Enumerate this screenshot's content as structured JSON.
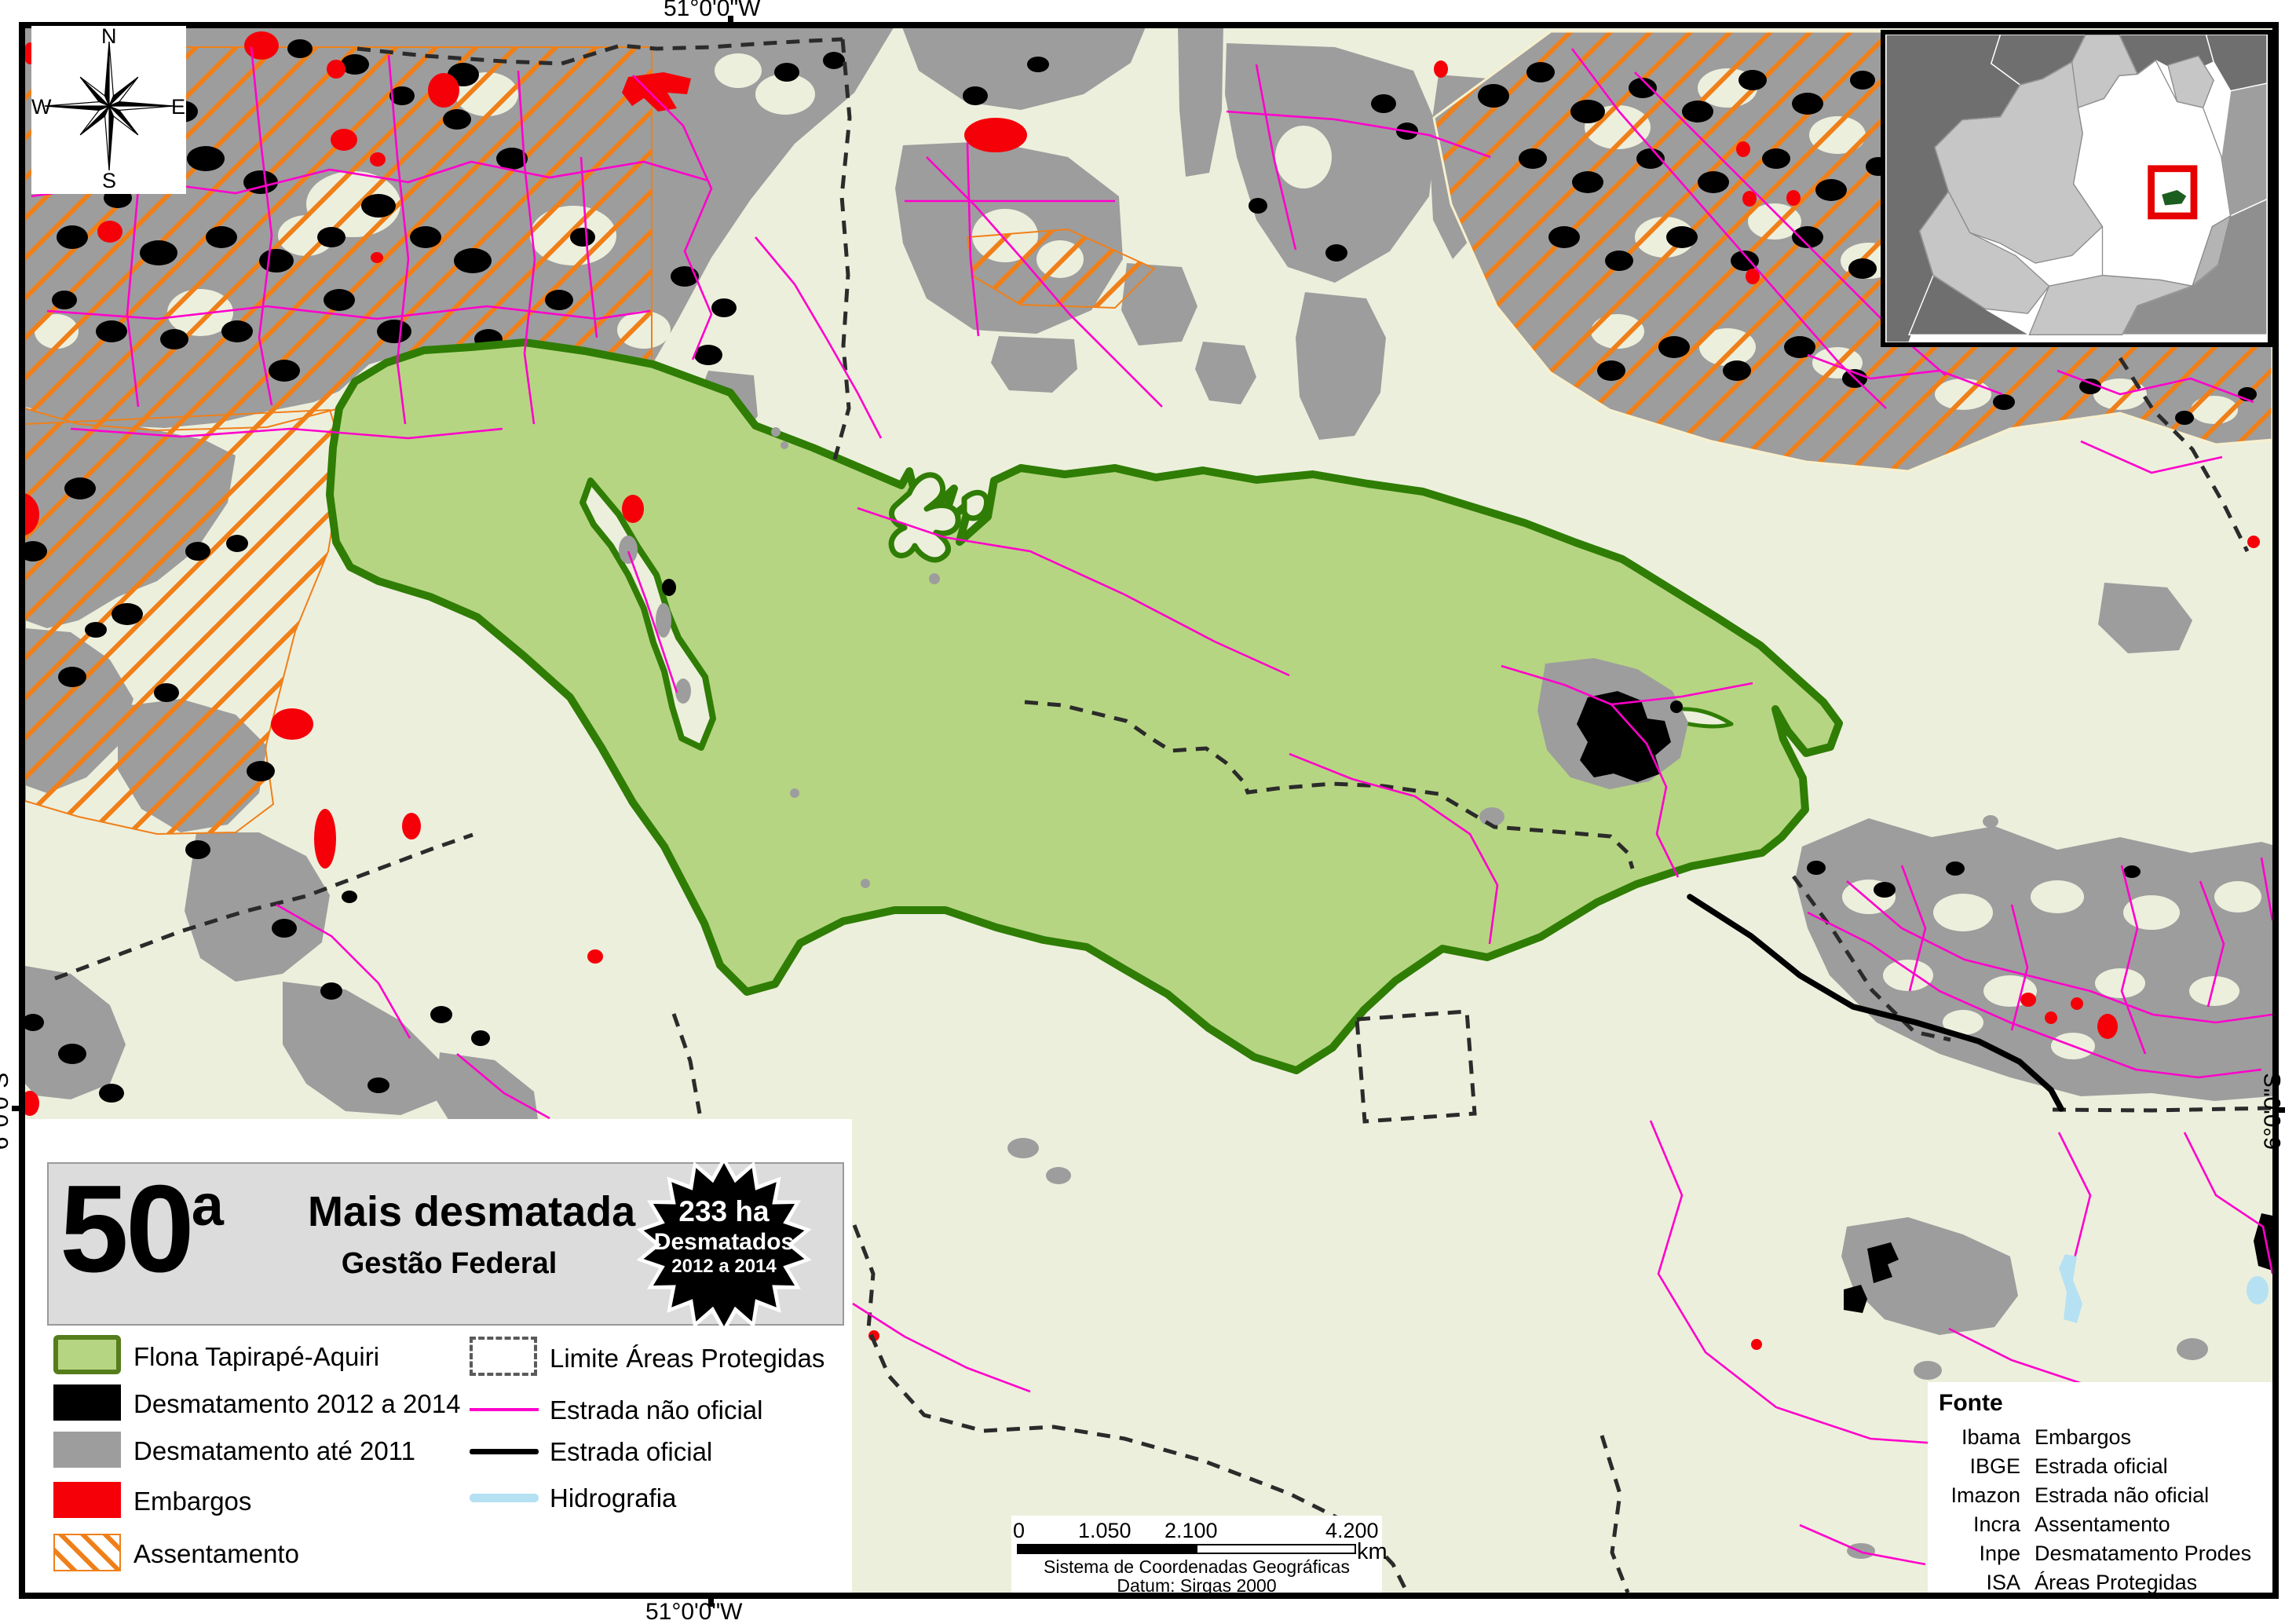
{
  "frame": {
    "coordinates": {
      "top": "51°0'0\"W",
      "bottom": "51°0'0\"W",
      "left": "6°0'0\"S",
      "right": "6°0'0\"S"
    }
  },
  "compass": {
    "n": "N",
    "e": "E",
    "s": "S",
    "w": "W"
  },
  "title_box": {
    "rank_number": "50",
    "rank_suffix": "a",
    "title": "Mais desmatada",
    "subtitle": "Gestão Federal"
  },
  "badge": {
    "line1": "233 ha",
    "line2": "Desmatados",
    "line3": "2012 a 2014"
  },
  "legend": {
    "col1": [
      {
        "label": "Flona Tapirapé-Aquiri",
        "color": "#b6d582",
        "border": "#567d1c"
      },
      {
        "label": "Desmatamento 2012 a 2014",
        "color": "#000000"
      },
      {
        "label": "Desmatamento até 2011",
        "color": "#9d9d9d"
      },
      {
        "label": "Embargos",
        "color": "#f50008"
      },
      {
        "label": "Assentamento",
        "color": "#ef8019",
        "style": "diagonal-hatch"
      }
    ],
    "col2": [
      {
        "label": "Limite Áreas Protegidas",
        "style": "dashed-outline",
        "color": "#5a5a5a"
      },
      {
        "label": "Estrada não oficial",
        "color": "#ff00cc"
      },
      {
        "label": "Estrada oficial",
        "color": "#000000"
      },
      {
        "label": "Hidrografia",
        "color": "#b5e1f3"
      }
    ]
  },
  "scale_bar": {
    "ticks": [
      "0",
      "1.050",
      "2.100",
      "4.200"
    ],
    "unit": "km",
    "crs_line1": "Sistema de Coordenadas Geográficas",
    "crs_line2": "Datum: Sirgas 2000"
  },
  "source_box": {
    "title": "Fonte",
    "entries": [
      {
        "source": "Ibama",
        "dataset": "Embargos"
      },
      {
        "source": "IBGE",
        "dataset": "Estrada oficial"
      },
      {
        "source": "Imazon",
        "dataset": "Estrada não oficial"
      },
      {
        "source": "Incra",
        "dataset": "Assentamento"
      },
      {
        "source": "Inpe",
        "dataset": "Desmatamento Prodes"
      },
      {
        "source": "ISA",
        "dataset": "Áreas Protegidas"
      }
    ]
  },
  "map": {
    "colors": {
      "map_background": "#edefdd",
      "flona_fill": "#b6d582",
      "flona_border": "#2f7d05",
      "deforestation_2012_2014": "#000000",
      "deforestation_until_2011": "#9d9d9d",
      "embargos": "#f50008",
      "assentamento_hatch": "#ef8019",
      "protected_area_limit": "#2b2b2b",
      "unofficial_road": "#ff00cc",
      "official_road": "#000000",
      "hydrography": "#b5e1f3",
      "inset_highlight_box": "#e60000"
    }
  }
}
